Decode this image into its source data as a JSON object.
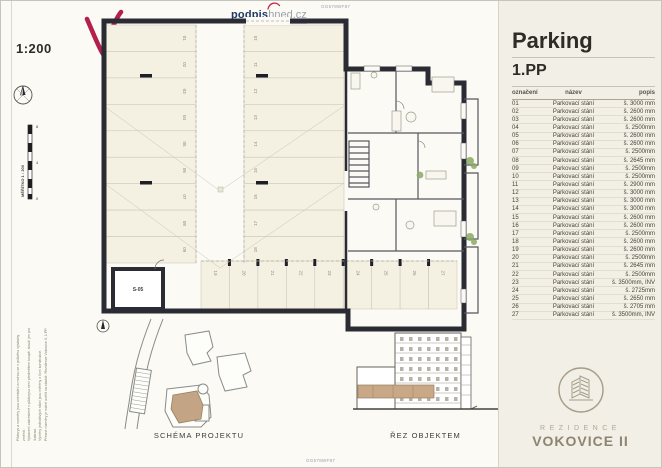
{
  "page": {
    "doc_code": "GG578WF87"
  },
  "watermark": {
    "logo_bold": "podpis",
    "logo_rest": "hned.cz"
  },
  "drawing": {
    "scale_label": "1:200",
    "scale_bar": {
      "label": "MĚŘÍTKO 1 : 200",
      "ticks": [
        "8",
        "4",
        "0"
      ]
    },
    "room_label": "S-05",
    "stalls_left": [
      "01",
      "02",
      "03",
      "04",
      "05",
      "06",
      "07",
      "08",
      "09"
    ],
    "stalls_right": [
      "10",
      "11",
      "12",
      "13",
      "14",
      "15",
      "16",
      "17",
      "18"
    ],
    "stalls_bottom": [
      "19",
      "20",
      "21",
      "22",
      "23",
      "24",
      "25",
      "26",
      "27"
    ],
    "fine_print": [
      "Půdorys a rozměry jsou orientační a mohou se v průběhu výstavby změnit.",
      "Vybavení zakreslené v půdorysu není předmětem koupě, slouží jen pro ilustraci.",
      "Výměry jednotlivých stání jsou měřeny z lícní konstrukce.",
      "Přesné rozměry je nutné ověřit na stavbě. Rezidence Vokovice II, 1.PP."
    ]
  },
  "panel": {
    "title": "Parking",
    "subtitle": "1.PP",
    "table": {
      "headers": {
        "id": "označení",
        "name": "název",
        "desc": "popis"
      },
      "row_name": "Parkovací stání",
      "rows": [
        {
          "id": "01",
          "desc": "š. 3000 mm"
        },
        {
          "id": "02",
          "desc": "š. 2600 mm"
        },
        {
          "id": "03",
          "desc": "š. 2600 mm"
        },
        {
          "id": "04",
          "desc": "š. 2500mm"
        },
        {
          "id": "05",
          "desc": "š. 2600 mm"
        },
        {
          "id": "06",
          "desc": "š. 2600 mm"
        },
        {
          "id": "07",
          "desc": "š. 2500mm"
        },
        {
          "id": "08",
          "desc": "š. 2645 mm"
        },
        {
          "id": "09",
          "desc": "š. 2500mm"
        },
        {
          "id": "10",
          "desc": "š. 2500mm"
        },
        {
          "id": "11",
          "desc": "š. 2900 mm"
        },
        {
          "id": "12",
          "desc": "š. 3000 mm"
        },
        {
          "id": "13",
          "desc": "š. 3000 mm"
        },
        {
          "id": "14",
          "desc": "š. 3000 mm"
        },
        {
          "id": "15",
          "desc": "š. 2600 mm"
        },
        {
          "id": "16",
          "desc": "š. 2600 mm"
        },
        {
          "id": "17",
          "desc": "š. 2500mm"
        },
        {
          "id": "18",
          "desc": "š. 2600 mm"
        },
        {
          "id": "19",
          "desc": "š. 2600 mm"
        },
        {
          "id": "20",
          "desc": "š. 2500mm"
        },
        {
          "id": "21",
          "desc": "š. 2645 mm"
        },
        {
          "id": "22",
          "desc": "š. 2500mm"
        },
        {
          "id": "23",
          "desc": "š. 3500mm, INV"
        },
        {
          "id": "24",
          "desc": "š. 2725mm"
        },
        {
          "id": "25",
          "desc": "š. 2650 mm"
        },
        {
          "id": "26",
          "desc": "š. 2705 mm"
        },
        {
          "id": "27",
          "desc": "š. 3500mm, INV"
        }
      ]
    }
  },
  "footer": {
    "schema_label": "SCHÉMA PROJEKTU",
    "section_label": "ŘEZ OBJEKTEM"
  },
  "brand": {
    "line1": "REZIDENCE",
    "line2": "VOKOVICE II"
  }
}
